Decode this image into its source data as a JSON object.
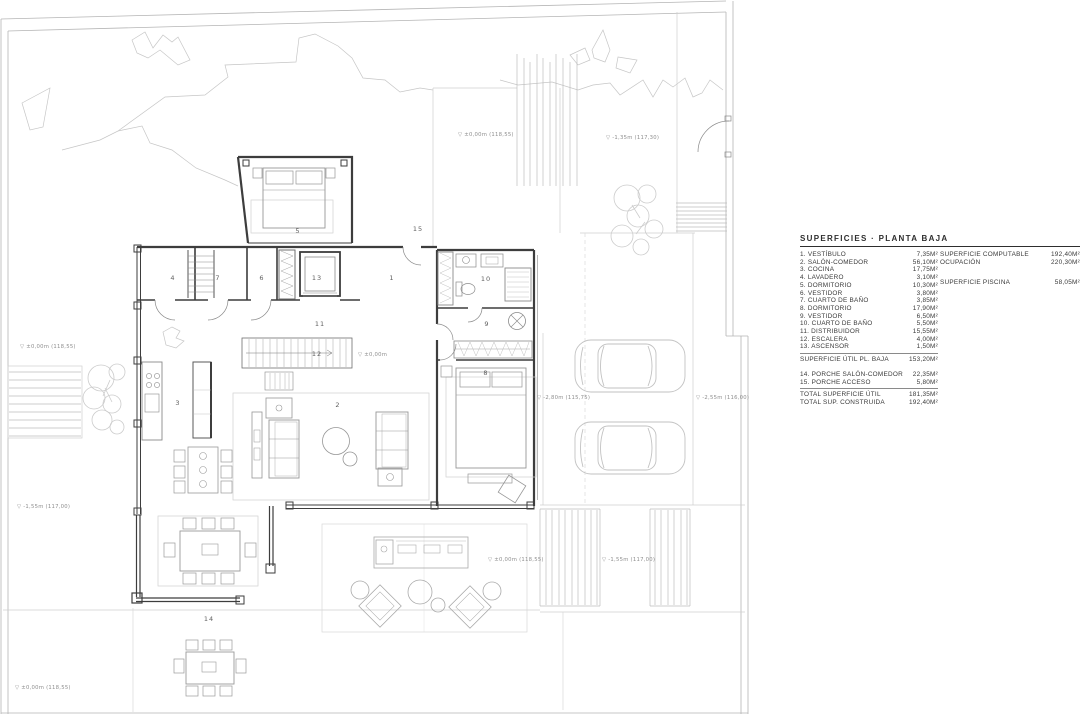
{
  "legend": {
    "title": "SUPERFICIES · PLANTA BAJA",
    "rooms": [
      {
        "num": "1.",
        "label": "VESTÍBULO",
        "value": "7,35M²"
      },
      {
        "num": "2.",
        "label": "SALÓN-COMEDOR",
        "value": "56,10M²"
      },
      {
        "num": "3.",
        "label": "COCINA",
        "value": "17,75M²"
      },
      {
        "num": "4.",
        "label": "LAVADERO",
        "value": "3,10M²"
      },
      {
        "num": "5.",
        "label": "DORMITORIO",
        "value": "10,30M²"
      },
      {
        "num": "6.",
        "label": "VESTIDOR",
        "value": "3,80M²"
      },
      {
        "num": "7.",
        "label": "CUARTO DE BAÑO",
        "value": "3,85M²"
      },
      {
        "num": "8.",
        "label": "DORMITORIO",
        "value": "17,90M²"
      },
      {
        "num": "9.",
        "label": "VESTIDOR",
        "value": "6,50M²"
      },
      {
        "num": "10.",
        "label": "CUARTO DE BAÑO",
        "value": "5,50M²"
      },
      {
        "num": "11.",
        "label": "DISTRIBUIDOR",
        "value": "15,55M²"
      },
      {
        "num": "12.",
        "label": "ESCALERA",
        "value": "4,00M²"
      },
      {
        "num": "13.",
        "label": "ASCENSOR",
        "value": "1,50M²"
      }
    ],
    "subtotal": {
      "label": "SUPERFICIE ÚTIL PL. BAJA",
      "value": "153,20M²"
    },
    "porches": [
      {
        "num": "14.",
        "label": "PORCHE SALÓN-COMEDOR",
        "value": "22,35M²"
      },
      {
        "num": "15.",
        "label": "PORCHE ACCESO",
        "value": "5,80M²"
      }
    ],
    "totals": [
      {
        "label": "TOTAL SUPERFICIE ÚTIL",
        "value": "181,35M²"
      },
      {
        "label": "TOTAL SUP. CONSTRUIDA",
        "value": "192,40M²"
      }
    ],
    "right_column": [
      {
        "label": "SUPERFICIE COMPUTABLE",
        "value": "192,40M²"
      },
      {
        "label": "OCUPACIÓN",
        "value": "220,30M²"
      },
      {
        "label": "SUPERFICIE PISCINA",
        "value": "58,05M²"
      }
    ]
  },
  "plan": {
    "room_numbers": [
      {
        "n": "1",
        "x": 392,
        "y": 280
      },
      {
        "n": "2",
        "x": 338,
        "y": 407
      },
      {
        "n": "3",
        "x": 178,
        "y": 405
      },
      {
        "n": "4",
        "x": 173,
        "y": 280
      },
      {
        "n": "5",
        "x": 298,
        "y": 233
      },
      {
        "n": "6",
        "x": 262,
        "y": 280
      },
      {
        "n": "7",
        "x": 218,
        "y": 280
      },
      {
        "n": "8",
        "x": 486,
        "y": 375
      },
      {
        "n": "9",
        "x": 487,
        "y": 326
      },
      {
        "n": "10",
        "x": 486,
        "y": 281
      },
      {
        "n": "11",
        "x": 320,
        "y": 326
      },
      {
        "n": "12",
        "x": 317,
        "y": 356
      },
      {
        "n": "13",
        "x": 317,
        "y": 280
      },
      {
        "n": "14",
        "x": 209,
        "y": 621
      },
      {
        "n": "15",
        "x": 418,
        "y": 231
      }
    ],
    "level_marks": [
      {
        "text": "▽ ±0,00m (118,55)",
        "x": 458,
        "y": 136
      },
      {
        "text": "▽ -1,35m (117,30)",
        "x": 606,
        "y": 139
      },
      {
        "text": "▽ ±0,00m (118,55)",
        "x": 20,
        "y": 348
      },
      {
        "text": "▽ ±0,00m",
        "x": 358,
        "y": 356
      },
      {
        "text": "▽ -2,80m (115,75)",
        "x": 537,
        "y": 399
      },
      {
        "text": "▽ -2,55m (116,00)",
        "x": 696,
        "y": 399
      },
      {
        "text": "▽ -1,55m (117,00)",
        "x": 17,
        "y": 508
      },
      {
        "text": "▽ ±0,00m (118,55)",
        "x": 488,
        "y": 561
      },
      {
        "text": "▽ -1,55m (117,00)",
        "x": 602,
        "y": 561
      },
      {
        "text": "▽ ±0,00m (118,55)",
        "x": 15,
        "y": 689
      }
    ]
  },
  "colors": {
    "wall": "#3d3d3d",
    "site_line": "#b5b5b5",
    "furniture_line": "#979797",
    "light_line": "#cfcfcf",
    "text": "#3a3a3a",
    "annotation": "#8f8f8f"
  }
}
